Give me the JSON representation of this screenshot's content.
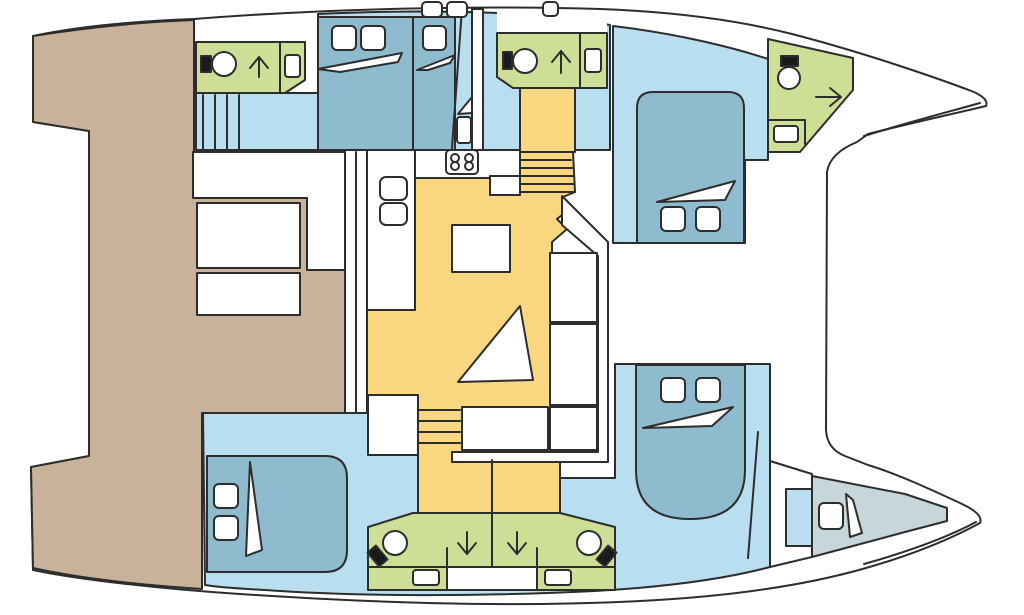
{
  "plan": {
    "kind": "catamaran-deck-floorplan",
    "orientation": "bows-pointing-right"
  },
  "colors": {
    "outline": "#2d2d2d",
    "white": "#ffffff",
    "deck_tan": "#c9b29b",
    "floor_blue": "#b9def0",
    "bed_blue": "#8fbbce",
    "head_green": "#cddf97",
    "saloon_yellow": "#f9d780",
    "vberth_gray": "#c7d6d9",
    "black": "#1a1a1a"
  },
  "icons": {
    "toilet": "circle-with-black-cistern",
    "shower_arrow_up": "arrow-up",
    "shower_arrow_down": "arrow-down",
    "door_arrow_right": "arrow-right",
    "sink": "small-rounded-rectangle",
    "stove": "four-burner-rounded-rectangle",
    "stairs": "parallel-step-lines",
    "bed": "panel-with-pillows-and-fold"
  },
  "regions": {
    "cockpit": "aft deck with bench seats and table",
    "saloon": "central saloon with galley, island, settee and triangular table",
    "hull_top": "hull with aft head, two cabins, mid head, forward island-bed cabin, forepeak head",
    "hull_bottom": "hull with aft cabin, twin shower heads, forward island-bed cabin, bow v-berth"
  }
}
